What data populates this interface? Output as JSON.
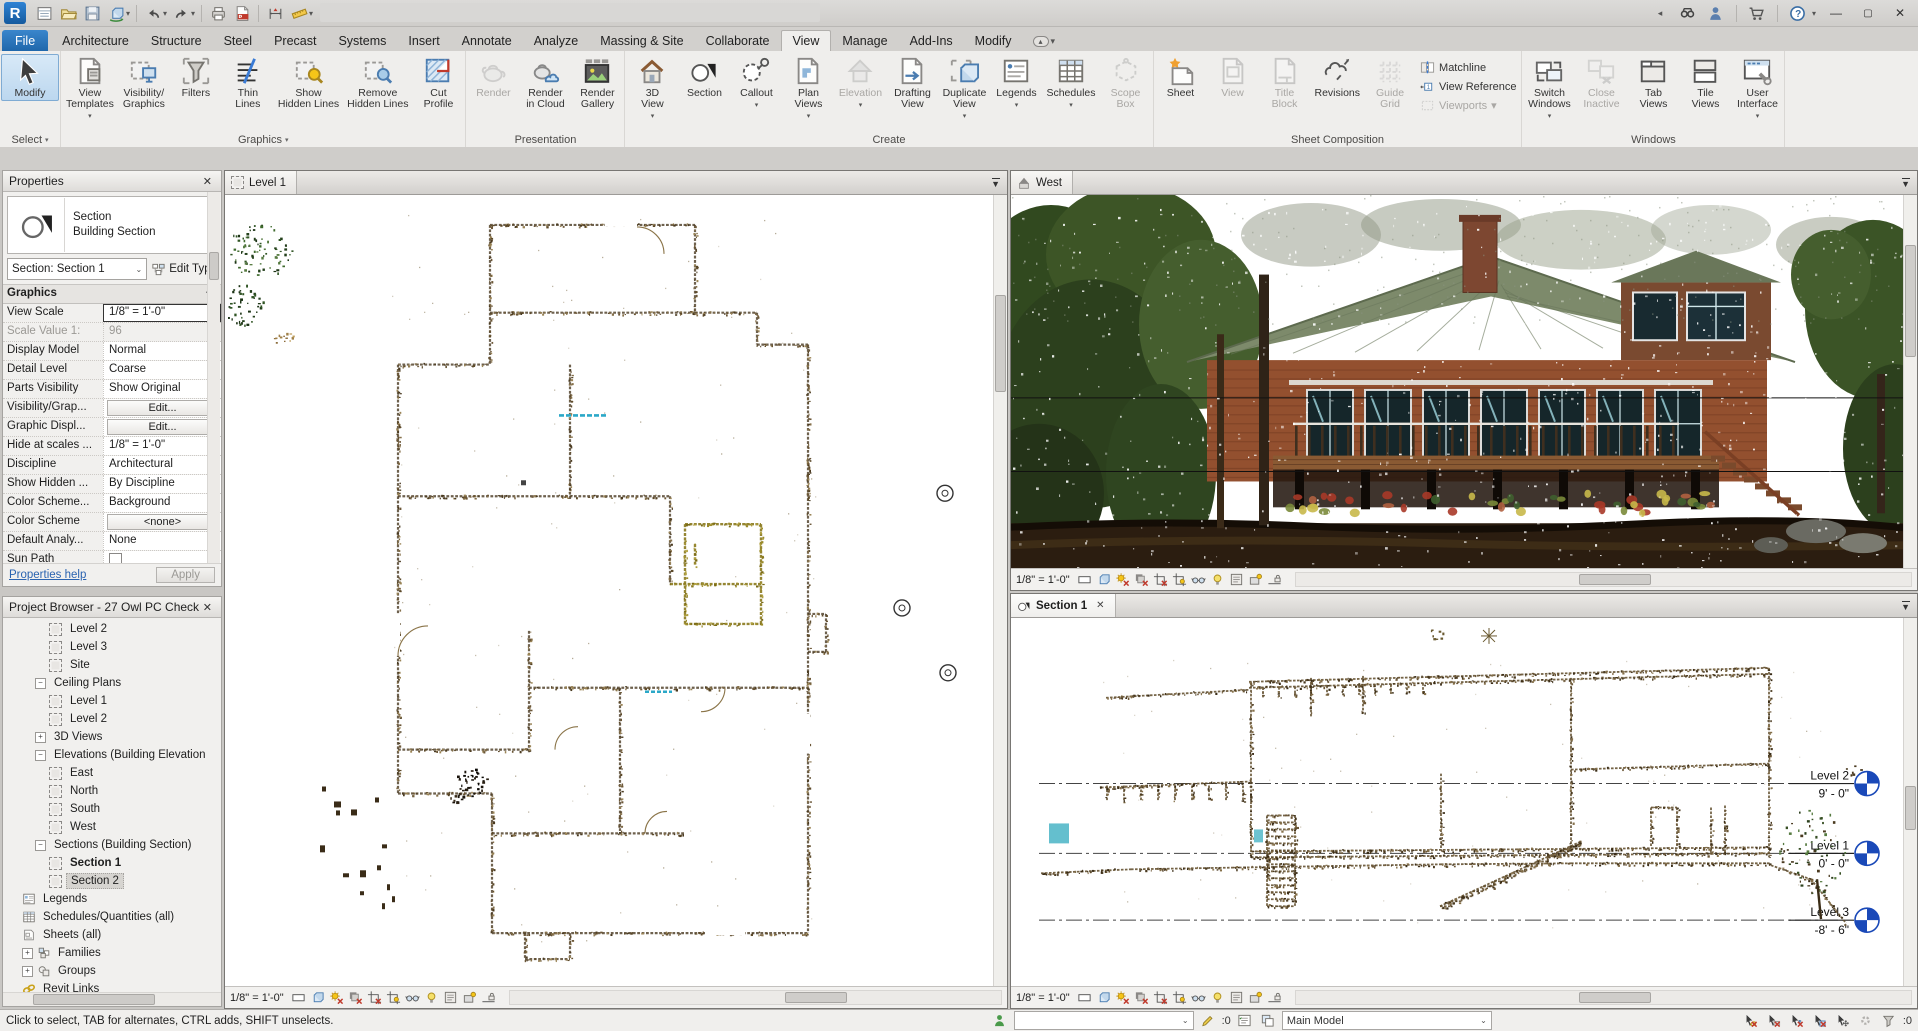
{
  "title_bar": {
    "qat": [
      {
        "name": "file-tabs"
      },
      {
        "name": "open"
      },
      {
        "name": "save"
      },
      {
        "name": "sync",
        "arrow": true
      },
      {
        "name": "sep"
      },
      {
        "name": "undo",
        "arrow": true
      },
      {
        "name": "redo",
        "arrow": true
      },
      {
        "name": "sep"
      },
      {
        "name": "print"
      },
      {
        "name": "export-pdf"
      },
      {
        "name": "sep"
      },
      {
        "name": "aligned-dimension"
      },
      {
        "name": "measure",
        "arrow": true
      },
      {
        "name": "modify-arrow"
      },
      {
        "name": "tag"
      },
      {
        "name": "text"
      },
      {
        "name": "sep"
      },
      {
        "name": "default-3d-view",
        "arrow": true
      },
      {
        "name": "section"
      },
      {
        "name": "thin-lines"
      },
      {
        "name": "sep"
      },
      {
        "name": "close-hidden-windows"
      },
      {
        "name": "switch-windows",
        "arrow": true
      },
      {
        "name": "customize",
        "arrow": true
      }
    ],
    "right_icons": [
      {
        "name": "collapse"
      },
      {
        "name": "search"
      },
      {
        "name": "sign-in"
      },
      {
        "name": "sep"
      },
      {
        "name": "store"
      },
      {
        "name": "sep"
      },
      {
        "name": "help",
        "arrow": true
      }
    ],
    "window_buttons": [
      {
        "name": "minimize",
        "glyph": "–"
      },
      {
        "name": "restore",
        "glyph": "❐"
      },
      {
        "name": "close",
        "glyph": "✕"
      }
    ]
  },
  "ribbon": {
    "tabs": [
      "File",
      "Architecture",
      "Structure",
      "Steel",
      "Precast",
      "Systems",
      "Insert",
      "Annotate",
      "Analyze",
      "Massing & Site",
      "Collaborate",
      "View",
      "Manage",
      "Add-Ins",
      "Modify"
    ],
    "active_tab": "View",
    "panels": [
      {
        "name": "Select",
        "arrow": true,
        "buttons": [
          {
            "label": "Modify",
            "icon": "cursor",
            "selected": true,
            "big": true
          }
        ]
      },
      {
        "name": "Graphics",
        "arrow": true,
        "buttons": [
          {
            "label": "View\nTemplates",
            "icon": "view-templates",
            "arrow": true
          },
          {
            "label": "Visibility/\nGraphics",
            "icon": "vis-graphics"
          },
          {
            "label": "Filters",
            "icon": "filters"
          },
          {
            "label": "Thin\nLines",
            "icon": "thin-lines"
          },
          {
            "label": "Show\nHidden Lines",
            "icon": "show-hidden"
          },
          {
            "label": "Remove\nHidden Lines",
            "icon": "remove-hidden"
          },
          {
            "label": "Cut\nProfile",
            "icon": "cut-profile"
          }
        ]
      },
      {
        "name": "Presentation",
        "buttons": [
          {
            "label": "Render",
            "icon": "render",
            "disabled": true
          },
          {
            "label": "Render\nin Cloud",
            "icon": "render-cloud"
          },
          {
            "label": "Render\nGallery",
            "icon": "render-gallery"
          }
        ]
      },
      {
        "name": "Create",
        "buttons": [
          {
            "label": "3D\nView",
            "icon": "home-3d",
            "arrow": true
          },
          {
            "label": "Section",
            "icon": "section-flag"
          },
          {
            "label": "Callout",
            "icon": "callout",
            "arrow": true
          },
          {
            "label": "Plan\nViews",
            "icon": "plan-views",
            "arrow": true
          },
          {
            "label": "Elevation",
            "icon": "elevation",
            "disabled": true,
            "arrow": true
          },
          {
            "label": "Drafting\nView",
            "icon": "drafting-view"
          },
          {
            "label": "Duplicate\nView",
            "icon": "duplicate-view",
            "arrow": true
          },
          {
            "label": "Legends",
            "icon": "legends",
            "arrow": true
          },
          {
            "label": "Schedules",
            "icon": "schedules",
            "arrow": true
          },
          {
            "label": "Scope\nBox",
            "icon": "scope-box",
            "disabled": true
          }
        ]
      },
      {
        "name": "Sheet Composition",
        "buttons": [
          {
            "label": "Sheet",
            "icon": "sheet"
          },
          {
            "label": "View",
            "icon": "view-port",
            "disabled": true
          },
          {
            "label": "Title\nBlock",
            "icon": "title-block",
            "disabled": true
          },
          {
            "label": "Revisions",
            "icon": "revisions"
          },
          {
            "label": "Guide\nGrid",
            "icon": "guide-grid",
            "disabled": true
          }
        ],
        "stack": [
          {
            "label": "Matchline",
            "icon": "matchline"
          },
          {
            "label": "View Reference",
            "icon": "view-reference"
          },
          {
            "label": "Viewports",
            "icon": "viewports",
            "disabled": true,
            "arrow": true
          }
        ]
      },
      {
        "name": "Windows",
        "buttons": [
          {
            "label": "Switch\nWindows",
            "icon": "switch-windows",
            "arrow": true
          },
          {
            "label": "Close\nInactive",
            "icon": "close-inactive",
            "disabled": true
          },
          {
            "label": "Tab\nViews",
            "icon": "tab-views"
          },
          {
            "label": "Tile\nViews",
            "icon": "tile-views"
          },
          {
            "label": "User\nInterface",
            "icon": "user-interface",
            "arrow": true
          }
        ]
      }
    ]
  },
  "properties": {
    "header": "Properties",
    "type_family": "Section",
    "type_name": "Building Section",
    "selector": "Section: Section 1",
    "edit_type_label": "Edit Type",
    "group": "Graphics",
    "rows": [
      {
        "label": "View Scale",
        "value": "1/8\" = 1'-0\"",
        "kind": "input"
      },
      {
        "label": "Scale Value    1:",
        "value": "96",
        "kind": "disabled"
      },
      {
        "label": "Display Model",
        "value": "Normal",
        "kind": "value"
      },
      {
        "label": "Detail Level",
        "value": "Coarse",
        "kind": "value"
      },
      {
        "label": "Parts Visibility",
        "value": "Show Original",
        "kind": "value"
      },
      {
        "label": "Visibility/Grap...",
        "value": "Edit...",
        "kind": "button"
      },
      {
        "label": "Graphic Displ...",
        "value": "Edit...",
        "kind": "button"
      },
      {
        "label": "Hide at scales ...",
        "value": "1/8\" = 1'-0\"",
        "kind": "value"
      },
      {
        "label": "Discipline",
        "value": "Architectural",
        "kind": "value"
      },
      {
        "label": "Show Hidden ...",
        "value": "By Discipline",
        "kind": "value"
      },
      {
        "label": "Color Scheme...",
        "value": "Background",
        "kind": "value"
      },
      {
        "label": "Color Scheme",
        "value": "<none>",
        "kind": "button"
      },
      {
        "label": "Default Analy...",
        "value": "None",
        "kind": "value"
      },
      {
        "label": "Sun Path",
        "value": "",
        "kind": "checkbox"
      }
    ],
    "help_link": "Properties help",
    "apply_label": "Apply"
  },
  "project_browser": {
    "header": "Project Browser - 27 Owl PC Check",
    "items": [
      {
        "label": "Level 2",
        "depth": 3,
        "icon": "view"
      },
      {
        "label": "Level 3",
        "depth": 3,
        "icon": "view"
      },
      {
        "label": "Site",
        "depth": 3,
        "icon": "view"
      },
      {
        "label": "Ceiling Plans",
        "depth": 2,
        "expand": "minus"
      },
      {
        "label": "Level 1",
        "depth": 3,
        "icon": "view"
      },
      {
        "label": "Level 2",
        "depth": 3,
        "icon": "view"
      },
      {
        "label": "3D Views",
        "depth": 2,
        "expand": "plus"
      },
      {
        "label": "Elevations (Building Elevation",
        "depth": 2,
        "expand": "minus"
      },
      {
        "label": "East",
        "depth": 3,
        "icon": "view"
      },
      {
        "label": "North",
        "depth": 3,
        "icon": "view"
      },
      {
        "label": "South",
        "depth": 3,
        "icon": "view"
      },
      {
        "label": "West",
        "depth": 3,
        "icon": "view"
      },
      {
        "label": "Sections (Building Section)",
        "depth": 2,
        "expand": "minus"
      },
      {
        "label": "Section 1",
        "depth": 3,
        "icon": "view",
        "bold": true
      },
      {
        "label": "Section 2",
        "depth": 3,
        "icon": "view",
        "selected": true
      },
      {
        "label": "Legends",
        "depth": 1,
        "icon": "legend"
      },
      {
        "label": "Schedules/Quantities (all)",
        "depth": 1,
        "icon": "schedule"
      },
      {
        "label": "Sheets (all)",
        "depth": 1,
        "icon": "sheet-s"
      },
      {
        "label": "Families",
        "depth": 1,
        "expand": "plus",
        "icon": "family"
      },
      {
        "label": "Groups",
        "depth": 1,
        "expand": "plus",
        "icon": "group"
      },
      {
        "label": "Revit Links",
        "depth": 1,
        "icon": "link"
      }
    ]
  },
  "views": {
    "level1": {
      "tab": "Level 1",
      "scale": "1/8\" = 1'-0\""
    },
    "west": {
      "tab": "West",
      "scale": "1/8\" = 1'-0\""
    },
    "section1": {
      "tab": "Section 1",
      "scale": "1/8\" = 1'-0\""
    },
    "section_levels": [
      {
        "name": "Level 2",
        "elevation": "9' - 0\""
      },
      {
        "name": "Level 1",
        "elevation": "0' - 0\""
      },
      {
        "name": "Level 3",
        "elevation": "-8' - 6\""
      }
    ],
    "control_icons": [
      "detail-level",
      "visual-style",
      "sun-path",
      "shadows",
      "crop-view",
      "show-crop-region",
      "temporary-hide-isolate",
      "reveal-hidden-elements",
      "temporary-view-properties",
      "worksharing-display",
      "reveal-constraints"
    ]
  },
  "status_bar": {
    "hint": "Click to select, TAB for alternates, CTRL adds, SHIFT unselects.",
    "active_workset": "",
    "editing_requests_count": ":0",
    "design_option": "Main Model",
    "filter_count": ":0",
    "left_icons": [
      "worksets",
      "workset-combo",
      "editing-requests",
      "worksets-display",
      "design-options",
      "design-option-combo"
    ],
    "right_icons": [
      "select-links",
      "select-underlay",
      "select-pinned",
      "select-by-face",
      "drag-on-selection",
      "background-processes",
      "filter"
    ]
  }
}
